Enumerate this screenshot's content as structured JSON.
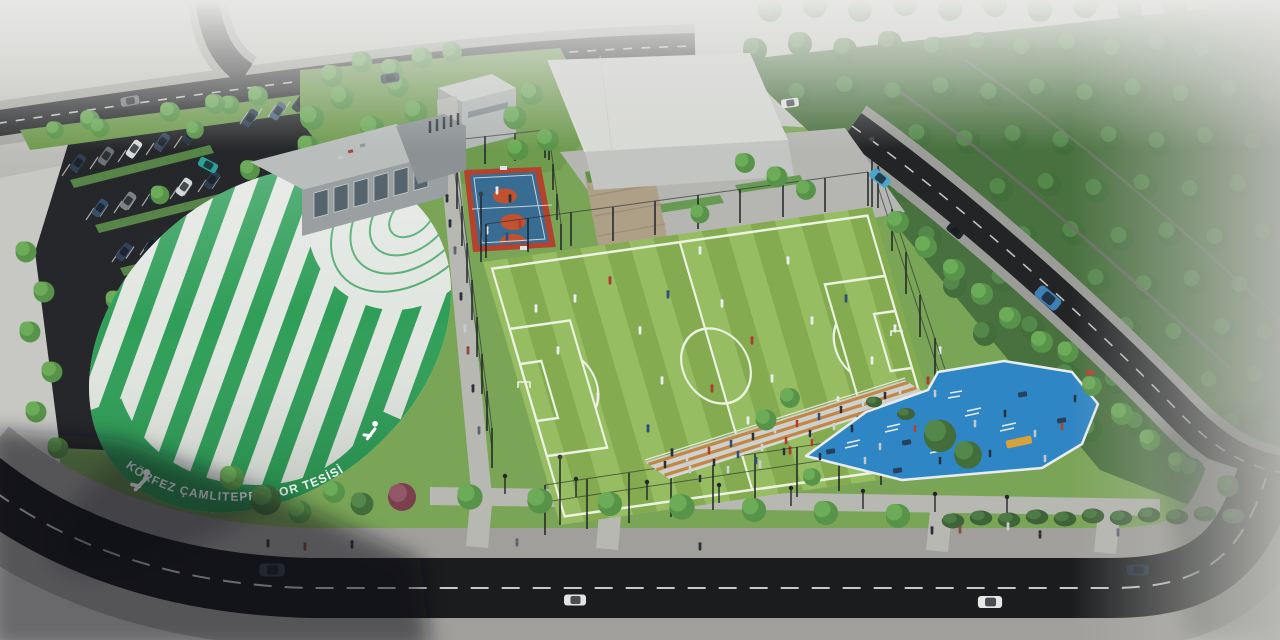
{
  "scene": {
    "dome_text": "KÖRFEZ ÇAMLITEPE SPOR TESİSİ"
  },
  "colors": {
    "haze": "#c7c7c4",
    "dome_green": "#2f9e58",
    "dome_white": "#e2e6e1",
    "pitch_light": "#97bd62",
    "pitch_dark": "#84ab50",
    "pitch_line": "#edf3e2",
    "court_blue": "#386c92",
    "court_orange": "#c2522f",
    "court_border": "#b3432f",
    "playground_blue": "#2f86c5",
    "asphalt": "#1b1c1e",
    "road_upper": "#2c2d2f",
    "sidewalk": "#a09f9b",
    "walkway": "#b7b8b2",
    "lawn": "#7aa557",
    "forest_base": "#49713f",
    "building_roof": "#d8dad6",
    "building_wall": "#c2c5c2",
    "wood": "#c08848"
  }
}
